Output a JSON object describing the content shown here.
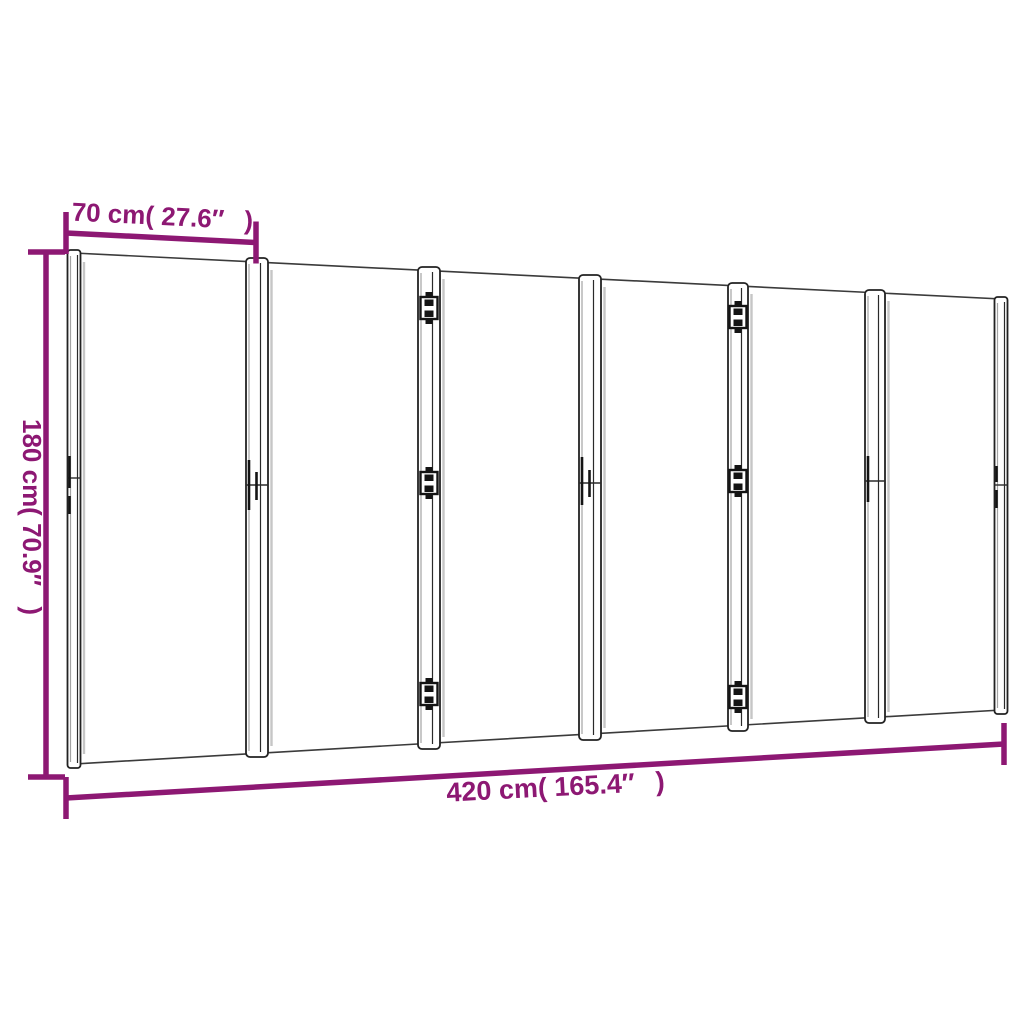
{
  "diagram": {
    "panel_count": 6,
    "labels": {
      "panel_width": "70 cm( 27.6″  )",
      "height": "180 cm( 70.9″  )",
      "total_width": "420 cm( 165.4″  )"
    },
    "colors": {
      "dimension_accent": "#8D1873",
      "outline": "#1D1D1D",
      "background": "#FFFFFF"
    }
  }
}
